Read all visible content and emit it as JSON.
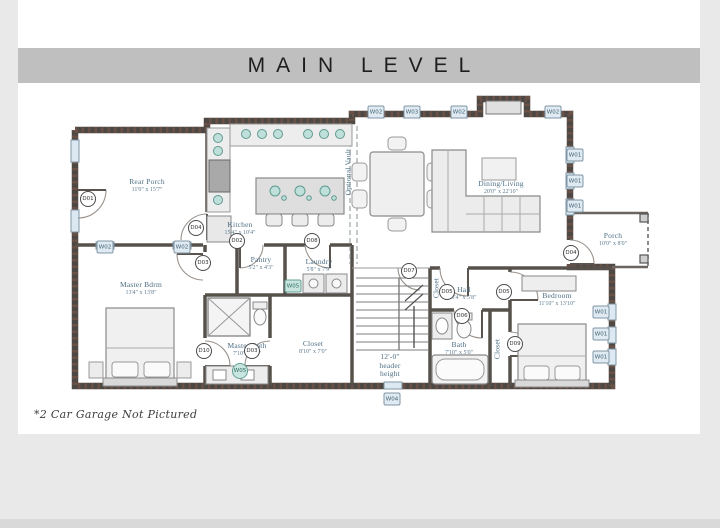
{
  "title": "MAIN LEVEL",
  "footnote": "*2 Car Garage Not Pictured",
  "colors": {
    "page_background": "#e9e9e9",
    "card_background": "#ffffff",
    "title_band": "#bfbfbf",
    "title_text": "#1e1e1e",
    "wall": "#4e4844",
    "wall_hatch": "#96604f",
    "label_blue": "#4d6f85",
    "window_tag_fill": "#dfeaf2",
    "teal_accent": "#c8e6df"
  },
  "plan": {
    "rooms": [
      {
        "name": "Rear Porch",
        "dims": "11'0\" x 15'7\"",
        "x": 147,
        "y": 186
      },
      {
        "name": "Kitchen",
        "dims": "15'4\" x 10'4\"",
        "x": 240,
        "y": 229
      },
      {
        "name": "Pantry",
        "dims": "5'2\" x 4'3\"",
        "x": 261,
        "y": 264
      },
      {
        "name": "Laundry",
        "dims": "5'8\" x 7'9\"",
        "x": 319,
        "y": 266
      },
      {
        "name": "Dining/Living",
        "dims": "20'0\" x 22'10\"",
        "x": 501,
        "y": 188
      },
      {
        "name": "Porch",
        "dims": "10'0\" x 8'0\"",
        "x": 613,
        "y": 240
      },
      {
        "name": "Master Bdrm",
        "dims": "13'4\" x 13'8\"",
        "x": 141,
        "y": 289
      },
      {
        "name": "Master Bath",
        "dims": "7'10\" x 8'0\"",
        "x": 247,
        "y": 350
      },
      {
        "name": "Closet",
        "dims": "8'10\" x 7'0\"",
        "x": 313,
        "y": 348
      },
      {
        "name": "Hall",
        "dims": "3'4\" x 5'8\"",
        "x": 464,
        "y": 294
      },
      {
        "name": "Bedroom",
        "dims": "11'10\" x 13'10\"",
        "x": 557,
        "y": 300
      },
      {
        "name": "Bath",
        "dims": "7'10\" x 5'0\"",
        "x": 459,
        "y": 349
      },
      {
        "name": "Optional Vault",
        "dims": "",
        "x": 349,
        "y": 172,
        "vertical": true
      },
      {
        "name": "Closet",
        "dims": "",
        "x": 437,
        "y": 288,
        "vertical": true
      },
      {
        "name": "Closet",
        "dims": "",
        "x": 498,
        "y": 349,
        "vertical": true
      },
      {
        "name": "12'-0\"\nheader\nheight",
        "dims": "",
        "x": 390,
        "y": 366
      }
    ],
    "door_tags": [
      {
        "label": "D01",
        "x": 88,
        "y": 199
      },
      {
        "label": "D04",
        "x": 196,
        "y": 228
      },
      {
        "label": "D03",
        "x": 203,
        "y": 263
      },
      {
        "label": "D02",
        "x": 237,
        "y": 241
      },
      {
        "label": "D08",
        "x": 312,
        "y": 241
      },
      {
        "label": "D07",
        "x": 409,
        "y": 271
      },
      {
        "label": "D05",
        "x": 447,
        "y": 292
      },
      {
        "label": "D05",
        "x": 504,
        "y": 292
      },
      {
        "label": "D06",
        "x": 462,
        "y": 316
      },
      {
        "label": "D10",
        "x": 204,
        "y": 351
      },
      {
        "label": "D03",
        "x": 252,
        "y": 351
      },
      {
        "label": "D09",
        "x": 515,
        "y": 344
      },
      {
        "label": "D04",
        "x": 571,
        "y": 253
      }
    ],
    "window_tags": [
      {
        "label": "W02",
        "x": 376,
        "y": 112
      },
      {
        "label": "W03",
        "x": 412,
        "y": 112
      },
      {
        "label": "W02",
        "x": 459,
        "y": 112
      },
      {
        "label": "W02",
        "x": 553,
        "y": 112
      },
      {
        "label": "W01",
        "x": 575,
        "y": 155
      },
      {
        "label": "W01",
        "x": 575,
        "y": 181
      },
      {
        "label": "W01",
        "x": 575,
        "y": 206
      },
      {
        "label": "W01",
        "x": 601,
        "y": 312
      },
      {
        "label": "W01",
        "x": 601,
        "y": 334
      },
      {
        "label": "W01",
        "x": 601,
        "y": 357
      },
      {
        "label": "W02",
        "x": 105,
        "y": 247
      },
      {
        "label": "W02",
        "x": 182,
        "y": 247
      },
      {
        "label": "W04",
        "x": 392,
        "y": 399
      }
    ],
    "accent_tags": [
      {
        "label": "W05",
        "shape": "square",
        "x": 293,
        "y": 286
      },
      {
        "label": "W05",
        "shape": "circle",
        "x": 240,
        "y": 371
      }
    ]
  }
}
